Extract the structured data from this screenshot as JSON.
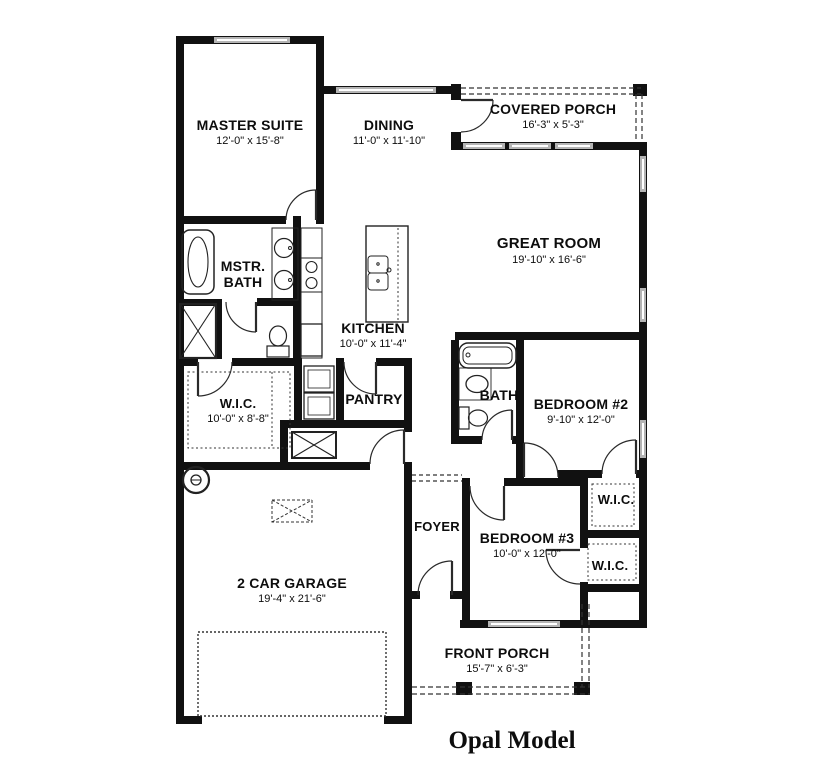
{
  "title": "Opal Model",
  "rooms": {
    "master_suite": {
      "name": "MASTER SUITE",
      "dims": "12'-0\" x 15'-8\""
    },
    "dining": {
      "name": "DINING",
      "dims": "11'-0\" x 11'-10\""
    },
    "covered_porch": {
      "name": "COVERED PORCH",
      "dims": "16'-3\" x 5'-3\""
    },
    "great_room": {
      "name": "GREAT ROOM",
      "dims": "19'-10\" x 16'-6\""
    },
    "mstr_bath": {
      "line1": "MSTR.",
      "line2": "BATH"
    },
    "kitchen": {
      "name": "KITCHEN",
      "dims": "10'-0\" x 11'-4\""
    },
    "wic_master": {
      "name": "W.I.C.",
      "dims": "10'-0\" x 8'-8\""
    },
    "pantry": {
      "name": "PANTRY"
    },
    "bath2": {
      "name": "BATH"
    },
    "bedroom2": {
      "name": "BEDROOM #2",
      "dims": "9'-10\" x 12'-0\""
    },
    "wic_bed2": {
      "name": "W.I.C."
    },
    "bedroom3": {
      "name": "BEDROOM #3",
      "dims": "10'-0\" x 12'-0\""
    },
    "wic_bed3": {
      "name": "W.I.C."
    },
    "foyer": {
      "name": "FOYER"
    },
    "garage": {
      "name": "2 CAR GARAGE",
      "dims": "19'-4\" x 21'-6\""
    },
    "front_porch": {
      "name": "FRONT PORCH",
      "dims": "15'-7\" x 6'-3\""
    }
  },
  "colors": {
    "wall": "#111111",
    "window": "#b4b4b4",
    "background": "#ffffff"
  }
}
